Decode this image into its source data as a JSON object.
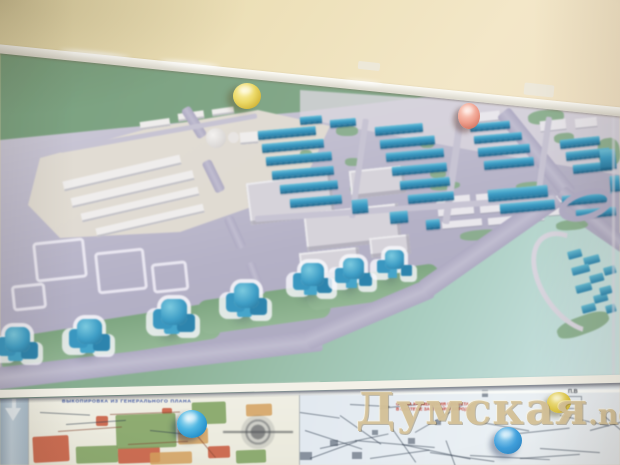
{
  "watermark": {
    "text": "Думская",
    "suffix": ".net"
  },
  "lower_posters": {
    "left_plan_title": "ВЫКОПИРОВКА ИЗ ГЕНЕРАЛЬНОГО ПЛАНА",
    "right_plan_title_line1": "СХЕМА РАЗМЕЩЕНИЯ ОБЪЕКТА",
    "right_plan_title_line2": "В СИСТЕМЕ ЗАСТРОЙКИ ГОРОДА",
    "corner_label": "П.В"
  },
  "colors": {
    "wall": "#efe3c2",
    "poster_green": "#7fa387",
    "map_ground": "#b9b6c8",
    "new_buildings": "#3f9ec6",
    "existing_buildings": "#e2dfe2",
    "road": "#b5b1c8",
    "watermark": "#d6c398"
  },
  "magnets": [
    {
      "name": "yellow-large",
      "hex": "#e8d763"
    },
    {
      "name": "pink",
      "hex": "#ea9f90"
    },
    {
      "name": "blue-large",
      "hex": "#2da0d8"
    },
    {
      "name": "yellow-small",
      "hex": "#dfc84a"
    },
    {
      "name": "blue-small",
      "hex": "#3f9fdc"
    }
  ],
  "map": {
    "layers": [
      {
        "n": "green-band",
        "c": "gband",
        "t": "map-shapes",
        "i": [
          [
            0,
            330,
            120,
            36,
            -9
          ],
          [
            88,
            312,
            132,
            36,
            -9
          ],
          [
            198,
            292,
            132,
            34,
            -8
          ],
          [
            306,
            272,
            134,
            30,
            -8
          ]
        ]
      },
      {
        "n": "green-patch",
        "c": "gpatch",
        "t": "map-shapes",
        "i": [
          [
            336,
            126,
            22,
            10,
            0
          ],
          [
            300,
            150,
            12,
            8,
            0
          ],
          [
            345,
            158,
            16,
            8,
            0
          ],
          [
            420,
            140,
            14,
            8,
            0
          ],
          [
            430,
            170,
            16,
            8,
            0
          ],
          [
            350,
            185,
            14,
            8,
            0
          ],
          [
            528,
            110,
            36,
            14,
            -6
          ],
          [
            554,
            133,
            20,
            10,
            -6
          ],
          [
            598,
            138,
            22,
            28,
            -8
          ],
          [
            430,
            182,
            30,
            8,
            -5
          ],
          [
            516,
            182,
            26,
            8,
            -5
          ],
          [
            556,
            220,
            32,
            10,
            -5
          ],
          [
            460,
            230,
            40,
            10,
            -5
          ],
          [
            556,
            316,
            54,
            18,
            -20
          ]
        ]
      },
      {
        "n": "district-footprint",
        "c": "footprint",
        "t": "map-shapes",
        "i": [
          [
            34,
            240,
            52,
            40,
            -6
          ],
          [
            96,
            250,
            50,
            42,
            -6
          ],
          [
            12,
            284,
            34,
            26,
            -6
          ],
          [
            152,
            262,
            36,
            30,
            -6
          ]
        ]
      },
      {
        "n": "existing-building",
        "c": "warehouse",
        "t": "map-shapes",
        "i": [
          [
            62,
            168,
            120,
            10,
            -13
          ],
          [
            70,
            184,
            125,
            10,
            -13
          ],
          [
            80,
            200,
            120,
            9,
            -13
          ],
          [
            95,
            216,
            110,
            9,
            -13
          ],
          [
            140,
            120,
            30,
            8,
            -8
          ],
          [
            178,
            112,
            26,
            8,
            -8
          ],
          [
            212,
            108,
            22,
            7,
            -8
          ],
          [
            240,
            132,
            18,
            12,
            -5
          ]
        ]
      },
      {
        "n": "industrial-building",
        "c": "flat",
        "t": "map-shapes",
        "i": [
          [
            248,
            178,
            85,
            42,
            -7
          ],
          [
            305,
            208,
            95,
            38,
            -6
          ],
          [
            350,
            168,
            55,
            28,
            -6
          ],
          [
            300,
            250,
            60,
            26,
            -6
          ],
          [
            370,
            236,
            40,
            20,
            -6
          ]
        ]
      },
      {
        "n": "garage-row",
        "c": "garage",
        "t": "map-shapes",
        "i": [
          [
            436,
            196,
            34,
            7,
            -5
          ],
          [
            476,
            193,
            30,
            7,
            -5
          ],
          [
            510,
            190,
            28,
            7,
            -5
          ],
          [
            438,
            208,
            36,
            7,
            -5
          ],
          [
            480,
            205,
            30,
            7,
            -5
          ],
          [
            514,
            202,
            26,
            7,
            -5
          ],
          [
            442,
            220,
            40,
            7,
            -5
          ],
          [
            488,
            217,
            28,
            7,
            -5
          ],
          [
            520,
            214,
            24,
            7,
            -5
          ],
          [
            545,
            196,
            18,
            7,
            -5
          ],
          [
            548,
            208,
            16,
            7,
            -5
          ],
          [
            470,
            112,
            30,
            9,
            -6
          ],
          [
            540,
            120,
            26,
            10,
            -6
          ],
          [
            575,
            118,
            22,
            9,
            -6
          ]
        ]
      },
      {
        "n": "road",
        "c": "road",
        "t": "map-shapes",
        "i": [
          [
            -6,
            368,
            330,
            22,
            -6.8
          ],
          [
            306,
            331,
            136,
            20,
            -23
          ],
          [
            424,
            280,
            162,
            20,
            -35
          ],
          [
            503,
            104,
            106,
            16,
            51
          ],
          [
            561,
            184,
            80,
            14,
            41
          ],
          [
            185,
            103,
            34,
            10,
            58
          ],
          [
            206,
            156,
            34,
            10,
            64
          ],
          [
            228,
            212,
            34,
            10,
            66
          ],
          [
            250,
            258,
            34,
            9,
            70
          ]
        ]
      },
      {
        "n": "street",
        "c": "roadthin",
        "t": "map-shapes",
        "i": [
          [
            356,
            118,
            6,
            100,
            8
          ],
          [
            450,
            112,
            7,
            112,
            8
          ],
          [
            540,
            116,
            6,
            90,
            8
          ],
          [
            255,
            216,
            300,
            6,
            -4
          ],
          [
            60,
            148,
            200,
            5,
            -10
          ]
        ]
      },
      {
        "n": "new-building-slab",
        "c": "slab",
        "t": "map-shapes",
        "i": [
          [
            258,
            131,
            58,
            9,
            -5
          ],
          [
            262,
            144,
            62,
            9,
            -5
          ],
          [
            266,
            157,
            66,
            9,
            -5
          ],
          [
            272,
            171,
            62,
            9,
            -5
          ],
          [
            280,
            185,
            58,
            9,
            -5
          ],
          [
            290,
            199,
            52,
            9,
            -5
          ],
          [
            375,
            127,
            48,
            9,
            -5
          ],
          [
            380,
            140,
            55,
            9,
            -5
          ],
          [
            386,
            153,
            58,
            9,
            -5
          ],
          [
            392,
            167,
            55,
            9,
            -5
          ],
          [
            400,
            181,
            50,
            9,
            -5
          ],
          [
            408,
            195,
            46,
            9,
            -5
          ],
          [
            470,
            124,
            40,
            8,
            -5
          ],
          [
            474,
            136,
            48,
            8,
            -5
          ],
          [
            478,
            148,
            52,
            9,
            -5
          ],
          [
            484,
            161,
            50,
            9,
            -5
          ],
          [
            560,
            140,
            40,
            9,
            -6
          ],
          [
            566,
            152,
            44,
            9,
            -6
          ],
          [
            573,
            165,
            40,
            9,
            -6
          ],
          [
            488,
            190,
            60,
            12,
            -5
          ],
          [
            500,
            204,
            55,
            10,
            -5
          ],
          [
            562,
            196,
            50,
            10,
            -5
          ],
          [
            576,
            210,
            40,
            9,
            -5
          ],
          [
            330,
            120,
            26,
            8,
            -5
          ],
          [
            300,
            117,
            22,
            8,
            -5
          ],
          [
            352,
            200,
            16,
            14,
            -5
          ],
          [
            390,
            212,
            18,
            12,
            -5
          ],
          [
            426,
            220,
            14,
            10,
            -5
          ],
          [
            600,
            150,
            16,
            20,
            -5
          ],
          [
            610,
            176,
            10,
            16,
            -5
          ]
        ]
      },
      {
        "n": "tower-cluster",
        "c": "tower",
        "t": "map-shapes",
        "i": [
          [
            28,
            350,
            46
          ],
          [
            100,
            342,
            46
          ],
          [
            185,
            323,
            48
          ],
          [
            257,
            306,
            46
          ],
          [
            322,
            284,
            42
          ],
          [
            362,
            277,
            38
          ],
          [
            402,
            267,
            34
          ]
        ]
      },
      {
        "n": "new-building-small",
        "c": "mini",
        "t": "map-shapes",
        "i": [
          [
            568,
            252,
            14,
            8,
            -15
          ],
          [
            584,
            258,
            16,
            8,
            -15
          ],
          [
            572,
            268,
            18,
            8,
            -15
          ],
          [
            590,
            276,
            14,
            8,
            -15
          ],
          [
            576,
            286,
            16,
            8,
            -15
          ],
          [
            594,
            296,
            14,
            8,
            -15
          ],
          [
            582,
            306,
            14,
            8,
            -15
          ],
          [
            600,
            288,
            12,
            8,
            -15
          ],
          [
            604,
            268,
            12,
            8,
            -15
          ],
          [
            606,
            306,
            10,
            8,
            -15
          ]
        ]
      },
      {
        "n": "plan-zone-red",
        "c": "zred",
        "t": "lower-shapes",
        "i": [
          [
            33,
            60,
            36,
            26,
            -3
          ],
          [
            118,
            71,
            42,
            16,
            -2
          ],
          [
            96,
            40,
            12,
            10,
            0
          ],
          [
            208,
            70,
            22,
            12,
            -2
          ],
          [
            162,
            32,
            10,
            6,
            0
          ]
        ]
      },
      {
        "n": "plan-zone-green",
        "c": "zgreen",
        "t": "lower-shapes",
        "i": [
          [
            76,
            70,
            42,
            17,
            -2
          ],
          [
            116,
            38,
            60,
            34,
            -2
          ],
          [
            192,
            26,
            34,
            22,
            -2
          ],
          [
            236,
            74,
            30,
            13,
            -2
          ]
        ]
      },
      {
        "n": "plan-zone-tan",
        "c": "ztan",
        "t": "lower-shapes",
        "i": [
          [
            150,
            76,
            42,
            12,
            -2
          ],
          [
            178,
            52,
            30,
            16,
            -2
          ],
          [
            246,
            28,
            26,
            12,
            -2
          ]
        ]
      },
      {
        "n": "plan-outline",
        "c": "plan-line",
        "t": "lower-shapes",
        "i": [
          [
            58,
            55,
            64,
            -4
          ],
          [
            128,
            68,
            60,
            -3
          ],
          [
            110,
            38,
            70,
            -2
          ],
          [
            186,
            46,
            46,
            50
          ]
        ]
      },
      {
        "n": "map-line",
        "c": "tline",
        "t": "lower-shapes",
        "i": [
          [
            305,
            54,
            60,
            18
          ],
          [
            320,
            72,
            70,
            -12
          ],
          [
            340,
            39,
            50,
            35
          ],
          [
            355,
            64,
            80,
            5
          ],
          [
            370,
            82,
            60,
            -8
          ],
          [
            390,
            49,
            45,
            55
          ],
          [
            402,
            68,
            70,
            12
          ],
          [
            415,
            56,
            55,
            -30
          ],
          [
            430,
            76,
            65,
            8
          ],
          [
            300,
            36,
            40,
            8
          ],
          [
            310,
            82,
            50,
            -20
          ],
          [
            446,
            64,
            40,
            70
          ],
          [
            470,
            44,
            60,
            10
          ],
          [
            500,
            59,
            70,
            -6
          ],
          [
            540,
            72,
            60,
            4
          ],
          [
            560,
            39,
            50,
            12
          ],
          [
            590,
            54,
            40,
            -15
          ],
          [
            470,
            79,
            80,
            3
          ],
          [
            520,
            82,
            60,
            -4
          ],
          [
            600,
            36,
            30,
            40
          ],
          [
            350,
            28,
            40,
            3
          ],
          [
            380,
            32,
            36,
            -6
          ],
          [
            40,
            36,
            50,
            3
          ],
          [
            66,
            48,
            60,
            -4
          ],
          [
            150,
            54,
            40,
            6
          ]
        ]
      },
      {
        "n": "map-mark",
        "c": "tdot",
        "t": "lower-shapes",
        "i": [
          [
            330,
            64,
            8,
            6,
            0
          ],
          [
            352,
            76,
            10,
            7,
            0
          ],
          [
            408,
            62,
            7,
            6,
            0
          ],
          [
            372,
            54,
            6,
            5,
            0
          ],
          [
            300,
            76,
            12,
            8,
            0
          ],
          [
            482,
            14,
            6,
            7,
            0
          ],
          [
            435,
            44,
            6,
            5,
            0
          ]
        ]
      }
    ]
  }
}
